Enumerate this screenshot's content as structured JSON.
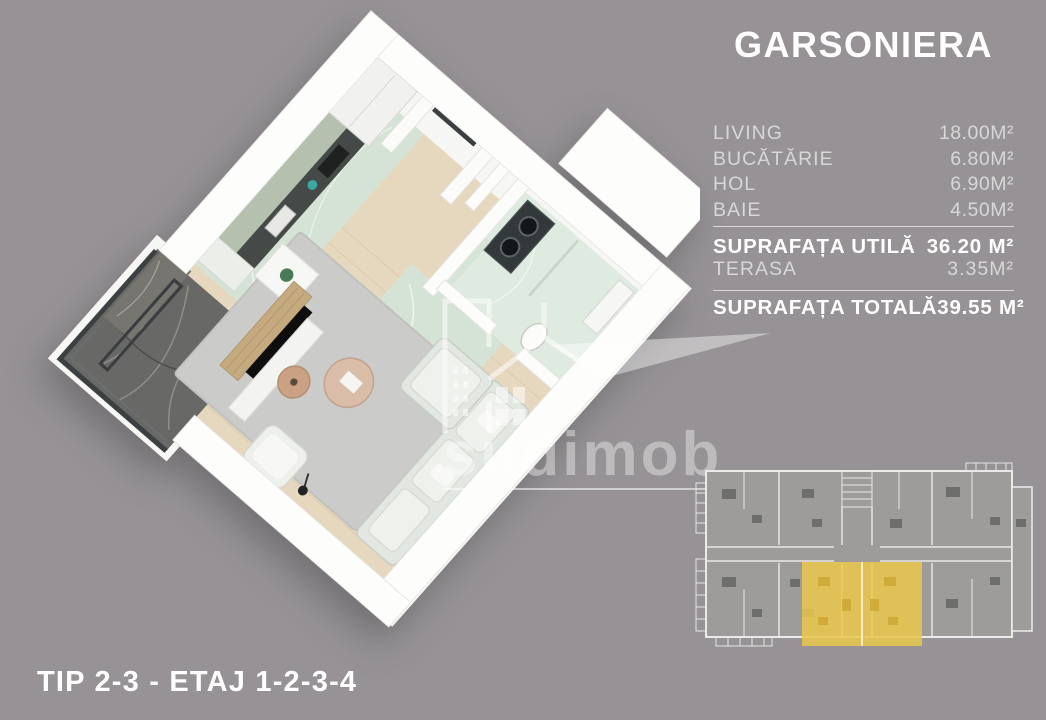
{
  "title": "GARSONIERA",
  "rooms": [
    {
      "label": "LIVING",
      "value": "18.00M²"
    },
    {
      "label": "BUCĂTĂRIE",
      "value": "6.80M²"
    },
    {
      "label": "HOL",
      "value": "6.90M²"
    },
    {
      "label": "BAIE",
      "value": "4.50M²"
    }
  ],
  "summary": {
    "utila_label": "SUPRAFAȚA UTILĂ",
    "utila_value": "36.20 M²",
    "terasa_label": "TERASA",
    "terasa_value": "3.35M²",
    "totala_label": "SUPRAFAȚA TOTALĂ",
    "totala_value": "39.55 M²"
  },
  "footer": "TIP 2-3 - ETAJ 1-2-3-4",
  "watermark": {
    "brand": "sudimob"
  },
  "mini_plan": {
    "highlighted_units": "2",
    "highlight_color": "#EAC84B"
  },
  "colors": {
    "background": "#969295",
    "text_primary": "#FFFFFF",
    "text_secondary": "#D9D7D8",
    "highlight_yellow": "#EAC84B",
    "kitchen_cabinet_sage": "#B6C0AE",
    "wood_floor": "#E6D8BF",
    "marble_green_floor": "#D5E3D6",
    "terrace_marble_dark": "#686866"
  }
}
